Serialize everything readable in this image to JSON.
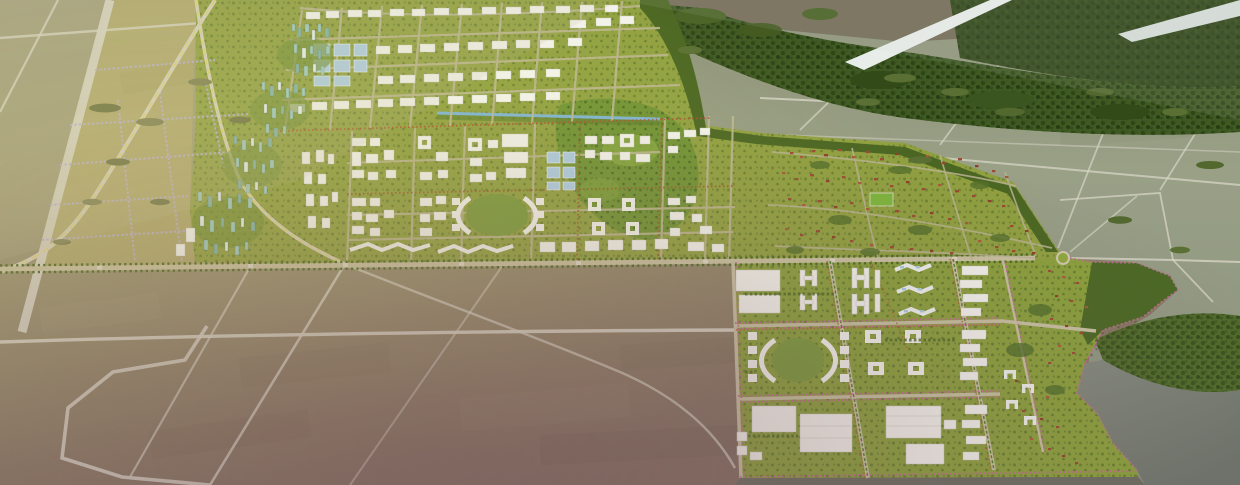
{
  "scene": {
    "alt": "Aerial oblique rendering of a planned city master plan on khaki farmland: white building grids and teal towers upper-left, tree-lined boulevard across the middle, red-roofed residential hill at right, white campus blocks lower-right, dark forest and a pale river at top right, gray water at bottom right",
    "type": "3d-city-masterplan-birdseye-render"
  },
  "palette": {
    "terrain_olive": "#a5a17e",
    "terrain_khaki": "#b2a96e",
    "terrain_gray_green": "#99a086",
    "terrain_mauve": "#8a7464",
    "water_gray": "#7d8478",
    "river_white": "#e9edea",
    "forest_dark": "#3f5a22",
    "park_green": "#6f9233",
    "city_green": "#90a040",
    "campus_green": "#8aa03c",
    "building_white": "#f3f3ed",
    "roof_blue": "#aecde3",
    "roof_red": "#9b4a33",
    "tower_teal": "#9ccac0",
    "road_light": "#d7d4c6",
    "road_yellow": "#ddd06a",
    "street_lavender": "#b9aed2",
    "street_pink": "#c9679f",
    "tree_green": "#4c6a24",
    "median_green": "#4e7f26",
    "shadow_strip": "#6a6d62"
  }
}
